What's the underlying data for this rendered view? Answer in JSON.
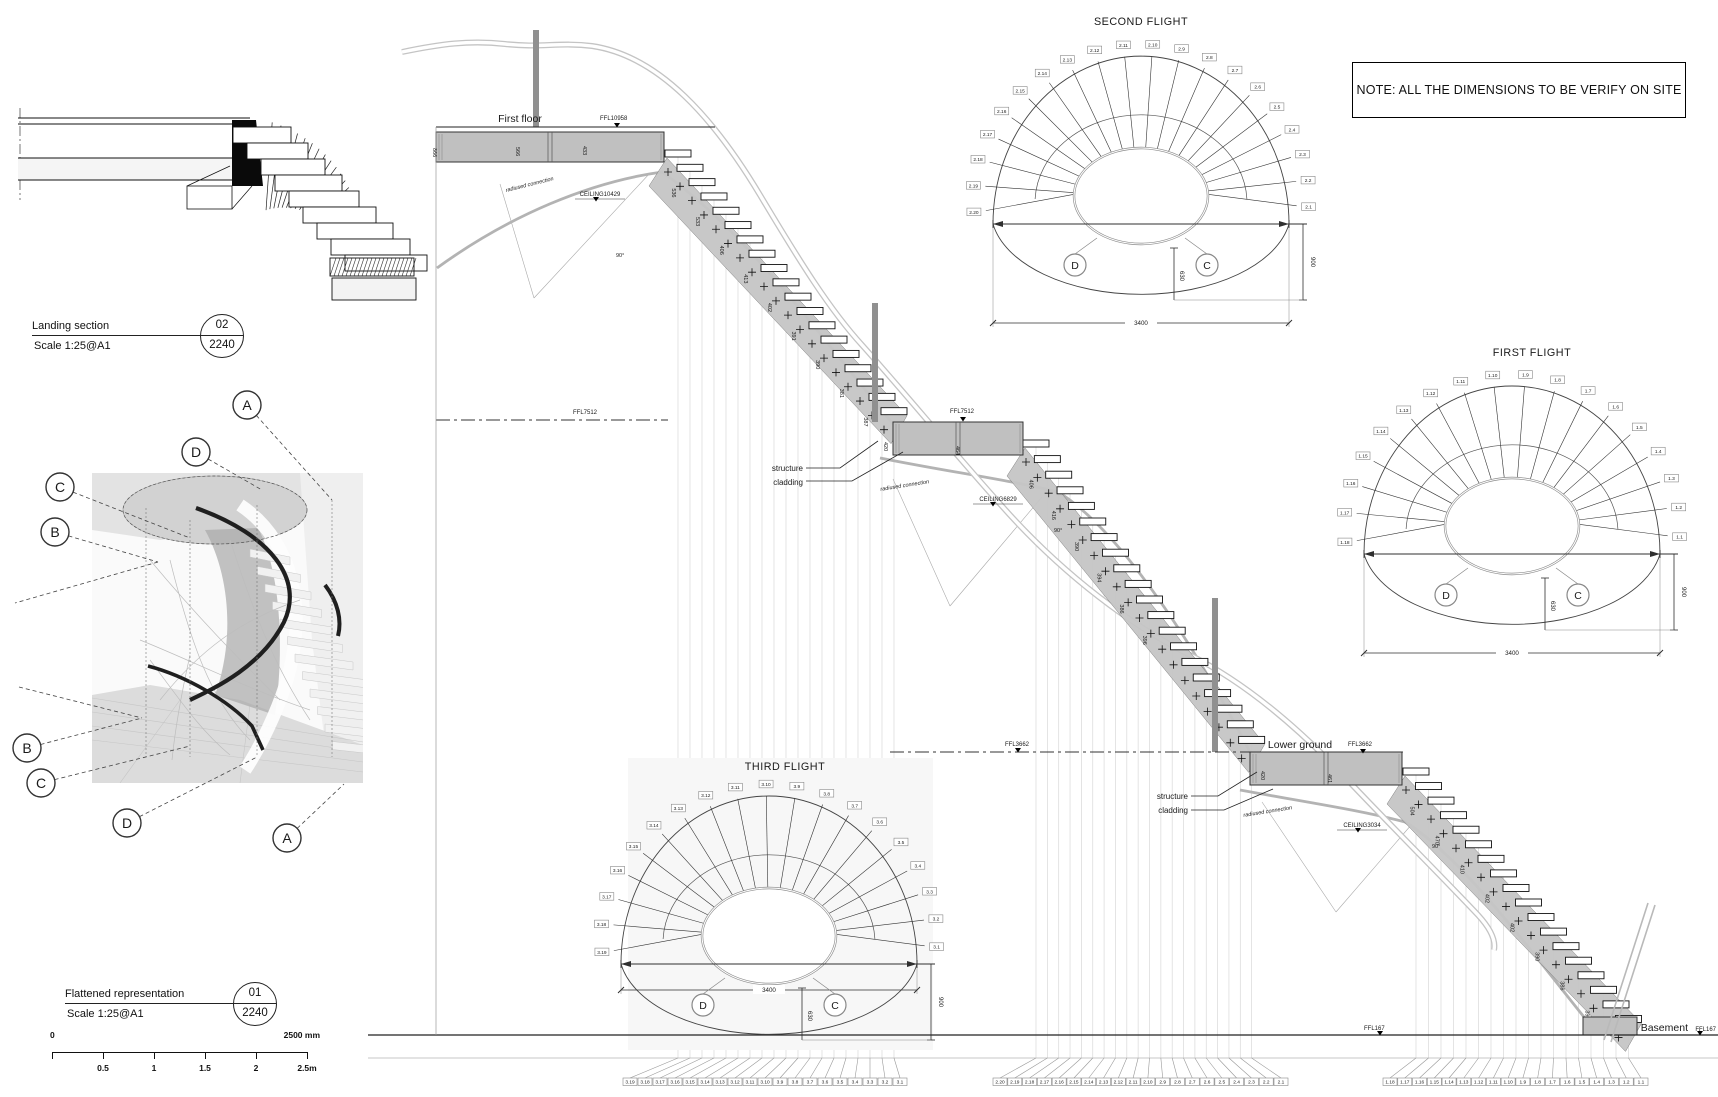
{
  "note": {
    "text": "NOTE: ALL THE DIMENSIONS TO BE VERIFY ON SITE"
  },
  "title_blocks": {
    "landing_section": {
      "title": "Landing section",
      "scale": "Scale 1:25@A1",
      "sheet_no": "02",
      "sheet_ref": "2240"
    },
    "flattened": {
      "title": "Flattened representation",
      "scale": "Scale 1:25@A1",
      "sheet_no": "01",
      "sheet_ref": "2240"
    }
  },
  "scale_bar": {
    "zero": "0",
    "end": "2500 mm",
    "ticks": [
      "0.5",
      "1",
      "1.5",
      "2",
      "2.5m"
    ]
  },
  "render_markers": {
    "top": [
      "A",
      "D",
      "C",
      "B"
    ],
    "bottom": [
      "B",
      "C",
      "D",
      "A"
    ]
  },
  "section": {
    "first_floor": "First floor",
    "ffl_first_floor": "FFL10958",
    "ceiling_first": "CEILING10429",
    "radiused": "radiused connection",
    "structure": "structure",
    "cladding": "cladding",
    "ffl_second": "FFL7512",
    "ceiling_second": "CEILING6829",
    "angle_90": "90°",
    "lower_ground": "Lower ground",
    "ffl_lower": "FFL3662",
    "ceiling_lower": "CEILING3034",
    "basement": "Basement",
    "ffl_basement": "FFL167"
  },
  "flights": [
    {
      "id": "second",
      "title": "SECOND FLIGHT",
      "marker_left": "D",
      "marker_right": "C",
      "dim_width": "3400",
      "dim_right": "900",
      "dim_center": "630",
      "treads": [
        "2.1",
        "2.2",
        "2.3",
        "2.4",
        "2.5",
        "2.6",
        "2.7",
        "2.8",
        "2.9",
        "2.10",
        "2.11",
        "2.12",
        "2.13",
        "2.14",
        "2.15",
        "2.16",
        "2.17",
        "2.18",
        "2.19",
        "2.20"
      ]
    },
    {
      "id": "first",
      "title": "FIRST FLIGHT",
      "marker_left": "D",
      "marker_right": "C",
      "dim_width": "3400",
      "dim_right": "900",
      "dim_center": "630",
      "treads": [
        "1.1",
        "1.2",
        "1.3",
        "1.4",
        "1.5",
        "1.6",
        "1.7",
        "1.8",
        "1.9",
        "1.10",
        "1.11",
        "1.12",
        "1.13",
        "1.14",
        "1.15",
        "1.16",
        "1.17",
        "1.18"
      ]
    },
    {
      "id": "third",
      "title": "THIRD FLIGHT",
      "marker_left": "D",
      "marker_right": "C",
      "dim_width": "3400",
      "dim_right": "900",
      "dim_center": "630",
      "treads": [
        "3.1",
        "3.2",
        "3.3",
        "3.4",
        "3.5",
        "3.6",
        "3.7",
        "3.8",
        "3.9",
        "3.10",
        "3.11",
        "3.12",
        "3.13",
        "3.14",
        "3.15",
        "3.16",
        "3.17",
        "3.18",
        "3.19"
      ]
    }
  ],
  "bottom_tags": {
    "third": [
      "3.19",
      "3.18",
      "3.17",
      "3.16",
      "3.15",
      "3.14",
      "3.13",
      "3.12",
      "3.11",
      "3.10",
      "3.9",
      "3.8",
      "3.7",
      "3.6",
      "3.5",
      "3.4",
      "3.3",
      "3.2",
      "3.1"
    ],
    "second": [
      "2.20",
      "2.19",
      "2.18",
      "2.17",
      "2.16",
      "2.15",
      "2.14",
      "2.13",
      "2.12",
      "2.11",
      "2.10",
      "2.9",
      "2.8",
      "2.7",
      "2.6",
      "2.5",
      "2.4",
      "2.3",
      "2.2",
      "2.1"
    ],
    "first": [
      "1.18",
      "1.17",
      "1.16",
      "1.15",
      "1.14",
      "1.13",
      "1.12",
      "1.11",
      "1.10",
      "1.9",
      "1.8",
      "1.7",
      "1.6",
      "1.5",
      "1.4",
      "1.3",
      "1.2",
      "1.1"
    ]
  },
  "riser_dims": {
    "landing_first_floor": [
      "866",
      "566",
      "433"
    ],
    "run_third": [
      "536",
      "533",
      "406",
      "413",
      "402",
      "391",
      "390",
      "381",
      "387",
      "390"
    ],
    "landing_second": [
      "420",
      "464"
    ],
    "run_second": [
      "406",
      "416",
      "390",
      "394",
      "386",
      "396"
    ],
    "landing_lower": [
      "420",
      "461"
    ],
    "run_first": [
      "504",
      "470",
      "410",
      "402",
      "402",
      "390",
      "386",
      "396"
    ]
  }
}
